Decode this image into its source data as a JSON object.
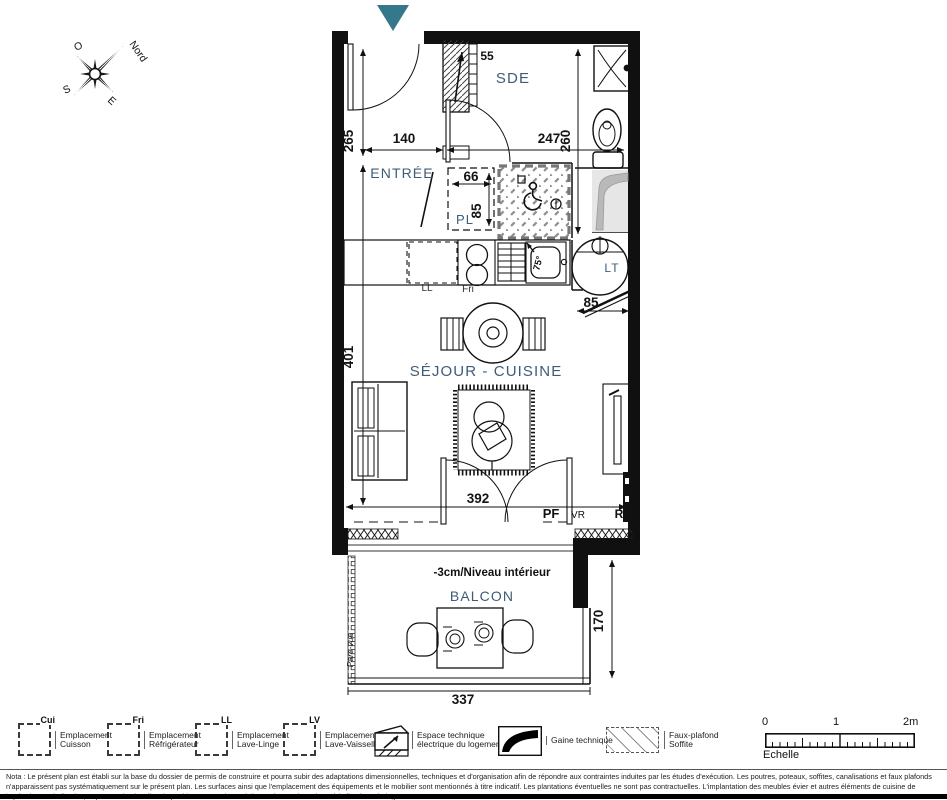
{
  "colors": {
    "accent_teal": "#35788a",
    "label_blue": "#3f5c77",
    "wall_black": "#101010"
  },
  "compass": {
    "north": "Nord",
    "west": "O",
    "south": "S",
    "east": "E"
  },
  "plan": {
    "rooms": {
      "sde": "SDE",
      "entree": "ENTRÉE",
      "pl": "PL",
      "sejour_cuisine": "SÉJOUR - CUISINE",
      "balcon": "BALCON"
    },
    "fixtures": {
      "ll": "LL",
      "fri": "Fri",
      "lt": "LT",
      "elec_dim": "55",
      "sink_angle": "75°",
      "pf": "PF",
      "vr": "VR",
      "r": "R"
    },
    "dims": {
      "entree_depth": "265",
      "entree_width": "140",
      "sde_width": "247",
      "sde_depth": "260",
      "pl_width": "66",
      "pl_depth": "85",
      "sejour_depth": "401",
      "sejour_width": "392",
      "kitchen_door": "85",
      "balcon_depth": "170",
      "balcon_width": "337"
    },
    "annotations": {
      "niveau": "-3cm/Niveau intérieur",
      "pare_vue": "Pare-vue"
    }
  },
  "legend": {
    "items": [
      {
        "tag": "Cui",
        "line1": "Emplacement",
        "line2": "Cuisson"
      },
      {
        "tag": "Fri",
        "line1": "Emplacement",
        "line2": "Réfrigérateur"
      },
      {
        "tag": "LL",
        "line1": "Emplacement",
        "line2": "Lave-Linge"
      },
      {
        "tag": "LV",
        "line1": "Emplacement",
        "line2": "Lave-Vaisselle"
      },
      {
        "line1": "Espace technique",
        "line2": "électrique du logement"
      },
      {
        "line1": "Gaine technique",
        "line2": ""
      },
      {
        "line1": "Faux-plafond",
        "line2": "Soffite"
      }
    ],
    "scale": {
      "t0": "0",
      "t1": "1",
      "t2": "2m",
      "label": "Echelle"
    }
  },
  "nota": "Nota : Le présent plan est établi sur la base du dossier de permis de construire et pourra subir des adaptations dimensionnelles, techniques et d'organisation afin de répondre aux contraintes induites par les études d'exécution. Les poutres, poteaux, soffites, canalisations et faux plafonds n'apparaissent pas systématiquement sur le présent plan. Les surfaces ainsi que l'emplacement des équipements et le mobilier sont mentionnés à titre indicatif. Les plantations éventuelles ne sont pas contractuelles. L'implantation des meubles évier et autres éléments de cuisine de l'opération est indicative, et permet de visualiser le positionnement des arrivées et évacuations d'eau à la livraison du logement."
}
